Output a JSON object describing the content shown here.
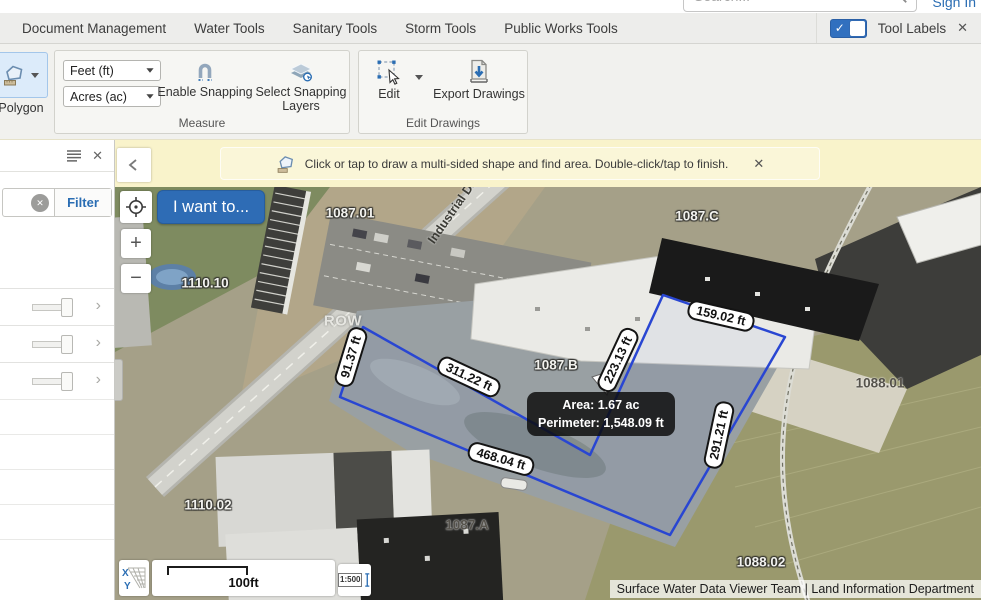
{
  "top": {
    "search_placeholder": "Search...",
    "sign_in": "Sign In"
  },
  "menu": {
    "items": [
      "Document Management",
      "Water Tools",
      "Sanitary Tools",
      "Storm Tools",
      "Public Works Tools"
    ],
    "tool_labels": "Tool Labels"
  },
  "toolbar": {
    "polygon": "Polygon",
    "measure": {
      "group": "Measure",
      "distance_unit": "Feet (ft)",
      "area_unit": "Acres (ac)",
      "enable_snapping": "Enable Snapping",
      "select_snapping_layers": "Select Snapping Layers"
    },
    "edit": {
      "group": "Edit Drawings",
      "edit": "Edit",
      "export": "Export Drawings"
    }
  },
  "notice": {
    "message": "Click or tap to draw a multi-sided shape and find area. Double-click/tap to finish."
  },
  "sidebar": {
    "filter": "Filter"
  },
  "map": {
    "i_want_to": "I want to...",
    "zoom_in": "+",
    "zoom_out": "−",
    "tooltip": {
      "area": "Area: 1.67 ac",
      "perimeter": "Perimeter: 1,548.09 ft"
    },
    "measurements": [
      {
        "text": "91.37 ft"
      },
      {
        "text": "311.22 ft"
      },
      {
        "text": "223.13 ft"
      },
      {
        "text": "159.02 ft"
      },
      {
        "text": "291.21 ft"
      },
      {
        "text": "468.04 ft"
      }
    ],
    "parcels": [
      {
        "text": "1087.01"
      },
      {
        "text": "1087.C"
      },
      {
        "text": "1110.10"
      },
      {
        "text": "1087.B"
      },
      {
        "text": "1088.01"
      },
      {
        "text": "1110.02"
      },
      {
        "text": "1087.A"
      },
      {
        "text": "1088.02"
      }
    ],
    "road_label": "Industrial Dr",
    "row_label": "ROW",
    "scale_bar": "100ft",
    "scale_ratio": "1:500",
    "attribution": "Surface Water Data Viewer Team | Land Information Department"
  },
  "icons": {
    "close": "✕",
    "chevron_right": "›",
    "check": "✓"
  },
  "colors": {
    "accent_blue": "#2e6cb5",
    "link_blue": "#2a6db3",
    "polygon_blue": "#2946d2",
    "notice_bg": "#f9f3cb",
    "toggle_blue": "#3170bf"
  }
}
